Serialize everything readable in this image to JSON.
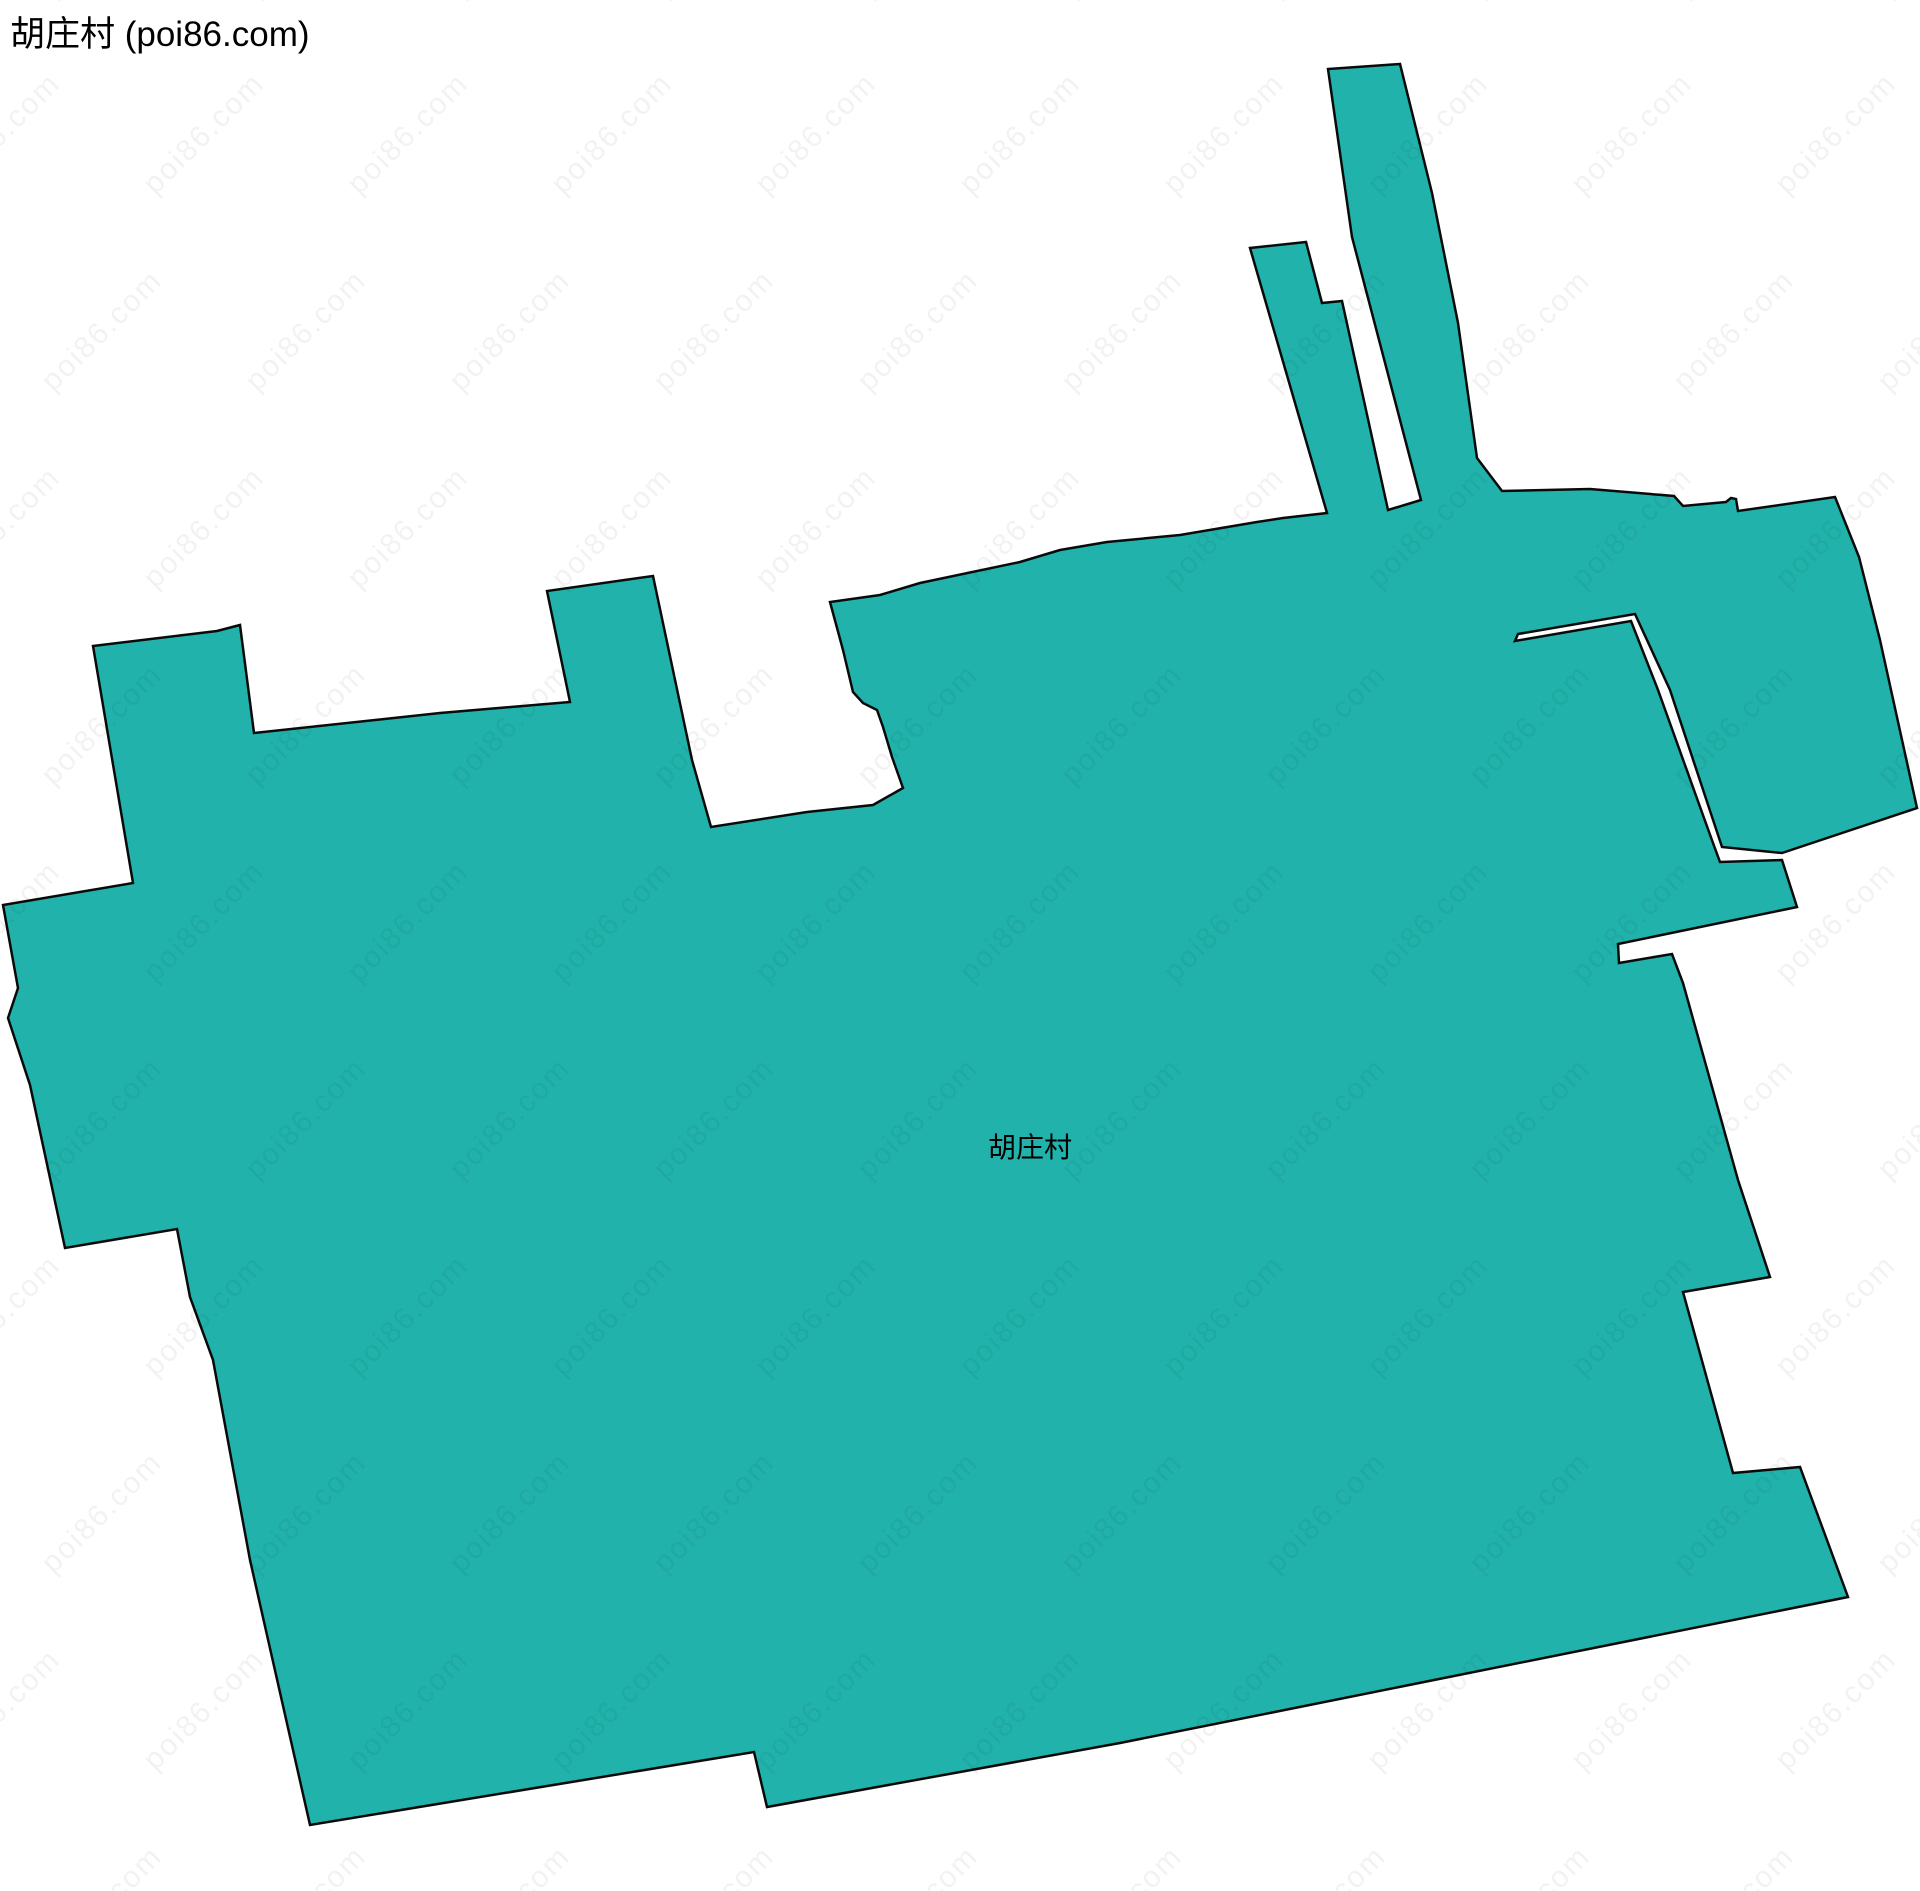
{
  "page": {
    "title": "胡庄村 (poi86.com)"
  },
  "map": {
    "region_label": "胡庄村",
    "label_position": {
      "x": 1030,
      "y": 1146
    },
    "fill_color": "#21B3AB",
    "stroke_color": "#0a0a0a",
    "stroke_width": 2.5,
    "canvas": {
      "width": 1920,
      "height": 1891
    },
    "polygon_points": [
      [
        93,
        646
      ],
      [
        217,
        631
      ],
      [
        240,
        625
      ],
      [
        254,
        733
      ],
      [
        440,
        713
      ],
      [
        570,
        702
      ],
      [
        547,
        591
      ],
      [
        653,
        576
      ],
      [
        692,
        760
      ],
      [
        711,
        827
      ],
      [
        807,
        812
      ],
      [
        873,
        805
      ],
      [
        903,
        788
      ],
      [
        892,
        757
      ],
      [
        883,
        727
      ],
      [
        877,
        710
      ],
      [
        863,
        703
      ],
      [
        853,
        692
      ],
      [
        843,
        650
      ],
      [
        830,
        602
      ],
      [
        880,
        595
      ],
      [
        920,
        583
      ],
      [
        1020,
        562
      ],
      [
        1060,
        550
      ],
      [
        1107,
        542
      ],
      [
        1180,
        535
      ],
      [
        1257,
        522
      ],
      [
        1283,
        518
      ],
      [
        1327,
        513
      ],
      [
        1250,
        248
      ],
      [
        1306,
        242
      ],
      [
        1322,
        303
      ],
      [
        1342,
        301
      ],
      [
        1388,
        510
      ],
      [
        1421,
        500
      ],
      [
        1352,
        237
      ],
      [
        1328,
        69
      ],
      [
        1400,
        64
      ],
      [
        1432,
        193
      ],
      [
        1458,
        323
      ],
      [
        1477,
        458
      ],
      [
        1502,
        491
      ],
      [
        1590,
        489
      ],
      [
        1674,
        496
      ],
      [
        1683,
        506
      ],
      [
        1726,
        502
      ],
      [
        1731,
        498
      ],
      [
        1736,
        499
      ],
      [
        1738,
        511
      ],
      [
        1835,
        497
      ],
      [
        1859,
        557
      ],
      [
        1880,
        640
      ],
      [
        1917,
        808
      ],
      [
        1782,
        853
      ],
      [
        1722,
        847
      ],
      [
        1670,
        690
      ],
      [
        1635,
        614
      ],
      [
        1518,
        634
      ],
      [
        1515,
        641
      ],
      [
        1631,
        621
      ],
      [
        1658,
        690
      ],
      [
        1713,
        843
      ],
      [
        1720,
        862
      ],
      [
        1782,
        860
      ],
      [
        1797,
        907
      ],
      [
        1618,
        944
      ],
      [
        1619,
        963
      ],
      [
        1672,
        954
      ],
      [
        1683,
        983
      ],
      [
        1738,
        1180
      ],
      [
        1770,
        1277
      ],
      [
        1683,
        1292
      ],
      [
        1733,
        1473
      ],
      [
        1800,
        1467
      ],
      [
        1848,
        1597
      ],
      [
        1120,
        1743
      ],
      [
        767,
        1807
      ],
      [
        754,
        1752
      ],
      [
        310,
        1825
      ],
      [
        250,
        1560
      ],
      [
        213,
        1360
      ],
      [
        190,
        1297
      ],
      [
        177,
        1229
      ],
      [
        65,
        1248
      ],
      [
        30,
        1085
      ],
      [
        8,
        1018
      ],
      [
        18,
        988
      ],
      [
        3,
        905
      ],
      [
        133,
        883
      ]
    ]
  },
  "watermark": {
    "text": "poi86.com",
    "color": "rgba(0,0,0,0.05)",
    "rotation_deg": -45,
    "col_step": 204,
    "row_step": 197,
    "row_offset": 102
  }
}
